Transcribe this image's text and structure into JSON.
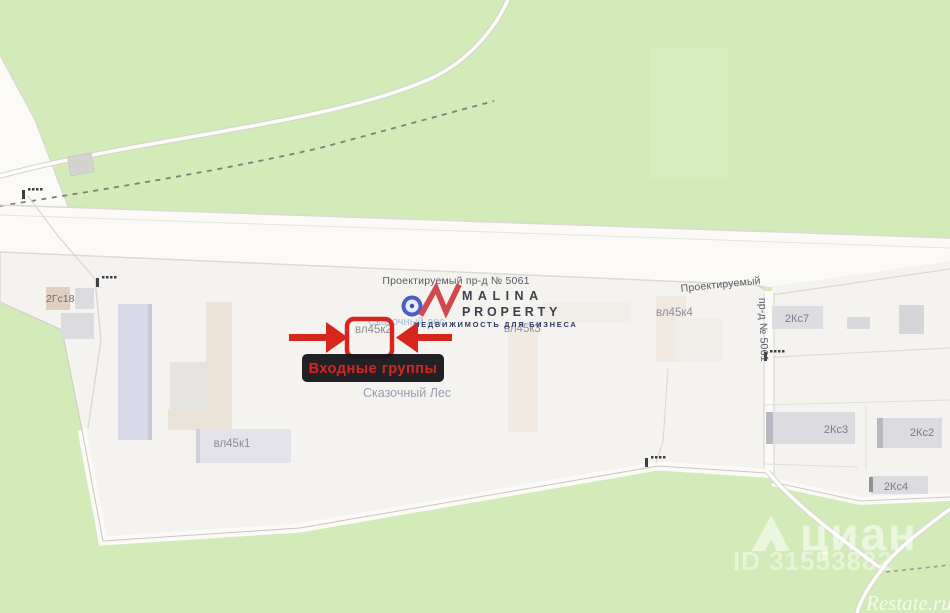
{
  "map": {
    "roads": {
      "main_label": "Проектируемый пр-д № 5061",
      "right_label_horizontal": "Проектируемый",
      "right_label_vertical": "пр-д № 5061"
    },
    "buildings": {
      "gs18": "2Гс18",
      "vl45k1": "вл45к1",
      "vl45k2": "вл45к2",
      "vl45k3": "вл45к3",
      "vl45k4": "вл45к4",
      "ks7": "2Кс7",
      "ks3": "2Кс3",
      "ks2": "2Кс2",
      "ks4": "2Кс4"
    },
    "areas": {
      "park_name": "Сказочный Лес",
      "park_name_blue": "Сказочный лес"
    }
  },
  "annotation": {
    "tooltip_text": "Входные группы",
    "accent_color": "#d7271c",
    "tooltip_bg": "#17151a"
  },
  "logo": {
    "name_line1": "MALINA",
    "name_line2": "PROPERTY",
    "tagline": "НЕДВИЖИМОСТЬ ДЛЯ БИЗНЕСА"
  },
  "watermarks": {
    "brand": "циан",
    "listing_id": "ID 31553882",
    "source_site": "Restate.ru"
  },
  "colors": {
    "forest_green": "#d2ebb8",
    "road_white": "#fbfaf6",
    "compound_white": "#f4f3ef",
    "label_gray": "#8e8c97",
    "road_label_gray": "#5a5864"
  }
}
